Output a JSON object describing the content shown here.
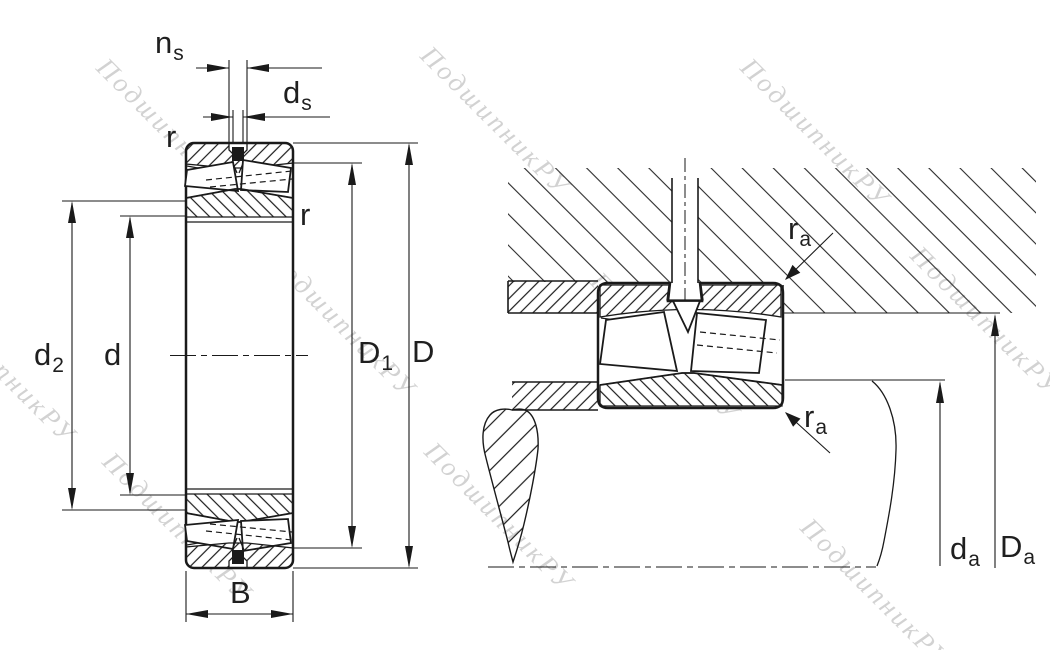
{
  "drawing": {
    "title": "spherical-roller-bearing-dimension-drawing",
    "background": "#ffffff",
    "line_color": "#1a1a1a",
    "watermark_text": "ПодшипникРУ",
    "watermark_color": "#b5b5b5",
    "views": {
      "left": "bearing-cross-section",
      "right": "mounting-abutment-cross-section"
    },
    "labels": {
      "ns": {
        "main": "n",
        "sub": "s"
      },
      "ds": {
        "main": "d",
        "sub": "s"
      },
      "r_top": {
        "main": "r",
        "sub": ""
      },
      "r_right": {
        "main": "r",
        "sub": ""
      },
      "d2": {
        "main": "d",
        "sub": "2"
      },
      "d": {
        "main": "d",
        "sub": ""
      },
      "D1": {
        "main": "D",
        "sub": "1"
      },
      "D": {
        "main": "D",
        "sub": ""
      },
      "B": {
        "main": "B",
        "sub": ""
      },
      "ra_top": {
        "main": "r",
        "sub": "a"
      },
      "ra_bottom": {
        "main": "r",
        "sub": "a"
      },
      "da": {
        "main": "d",
        "sub": "a"
      },
      "Da": {
        "main": "D",
        "sub": "a"
      }
    }
  }
}
